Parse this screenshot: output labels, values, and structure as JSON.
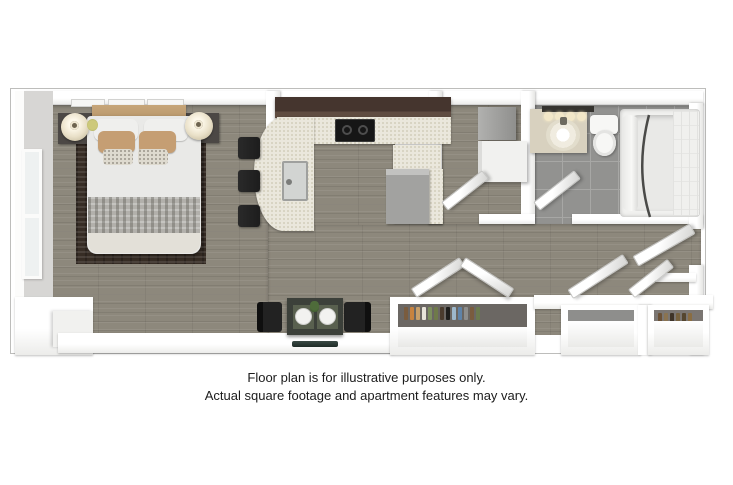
{
  "disclaimer": {
    "line1": "Floor plan is for illustrative purposes only.",
    "line2": "Actual square footage and apartment features may vary."
  },
  "floorplan": {
    "border_color": "#bdbdbb",
    "colors": {
      "wood_floor": "#8d887c",
      "tile_floor": "#929290",
      "tile_grout": "#a7a7a5",
      "counter": "#eae7dc",
      "counter_speckle": "#d2cdbb",
      "cabinet_dark": "#45352e",
      "cabinet_front": "#5f4c41",
      "stove": "#161616",
      "appliance_gray": "#a2a2a0",
      "washer_white": "#f1f1ef",
      "fixture_white": "#f7f7f5",
      "tub_inner": "#e9e9e7",
      "vanity": "#d8d1bf",
      "light_bar": "#35332f",
      "bulb": "#f2e7c8",
      "bed_duvet": "#e9e9e7",
      "pillow_white": "#efefed",
      "pillow_tan": "#c59e73",
      "pillow_accent": "#dedacf",
      "headboard": "#b8976c",
      "blanket_gray": "#b2b0ab",
      "bed_foot": "#e3e0d8",
      "rug_dark": "#372d25",
      "nightstand": "#4c4845",
      "lamp": "#e9e0c8",
      "stool_dark": "#1d1d1d",
      "chair_dark": "#222222",
      "table_dark": "#3c403a",
      "placemat": "#59604f",
      "tv_dark": "#1f2b27",
      "plate": "#f2f2f0",
      "plant_green": "#4e6b3a",
      "closet_back_a": "#6b6763",
      "closet_back_b": "#8e8e8c",
      "closet_back_c": "#7b7672",
      "wall_gray": "#d7d6d4"
    },
    "closet_a_items": [
      "#7a5c3e",
      "#c8833f",
      "#c9a06a",
      "#e8e4da",
      "#7d8f5e",
      "#6f7a4a",
      "#4a3b2d",
      "#1d1d1b",
      "#9db8cc",
      "#5f83a8",
      "#8e8e8c",
      "#7a5c3e",
      "#6b7a4e"
    ],
    "closet_c_items": [
      "#6b5136",
      "#8a7351",
      "#3f3428",
      "#77623f",
      "#55462f",
      "#8a6d42"
    ]
  }
}
